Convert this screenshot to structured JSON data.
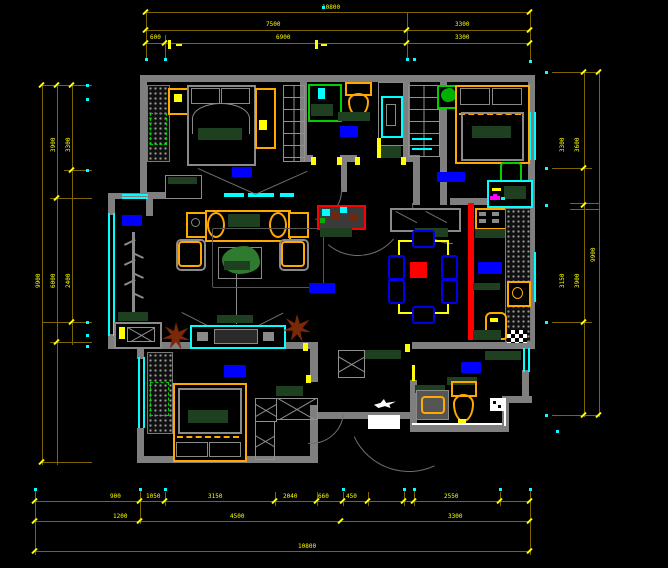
{
  "drawing": {
    "kind": "apartment-floor-plan",
    "background": "#000000"
  },
  "colors": {
    "wall": "#7f7f7f",
    "dimension_line": "#7d6500",
    "dimension_text": "#ffff00",
    "window": "#00ffff",
    "room_label": "#0000ff",
    "furniture_accent": "#ffa800",
    "cabinet_fill": "#1f4020",
    "highlight": "#ff0000",
    "plant_brown": "#7a2808",
    "plant_green": "#00d000"
  },
  "dimensions": {
    "top": {
      "total": "10800",
      "row2": [
        "7500",
        "3300"
      ],
      "row3": [
        "600",
        "6900",
        "3300"
      ]
    },
    "bottom": {
      "row1": [
        "900",
        "1050",
        "3150",
        "2040",
        "660",
        "450",
        "2550"
      ],
      "row2": [
        "1200",
        "4500",
        "3300"
      ],
      "total": "10800"
    },
    "left": {
      "inner": [
        "3300",
        "2400"
      ],
      "mid": [
        "3900",
        "6000"
      ],
      "total": "9900"
    },
    "right": {
      "inner": [
        "3300",
        "3150"
      ],
      "mid": [
        "3600",
        "3900"
      ],
      "total": "9900"
    }
  },
  "icons": {
    "logo": "bird-logo"
  }
}
